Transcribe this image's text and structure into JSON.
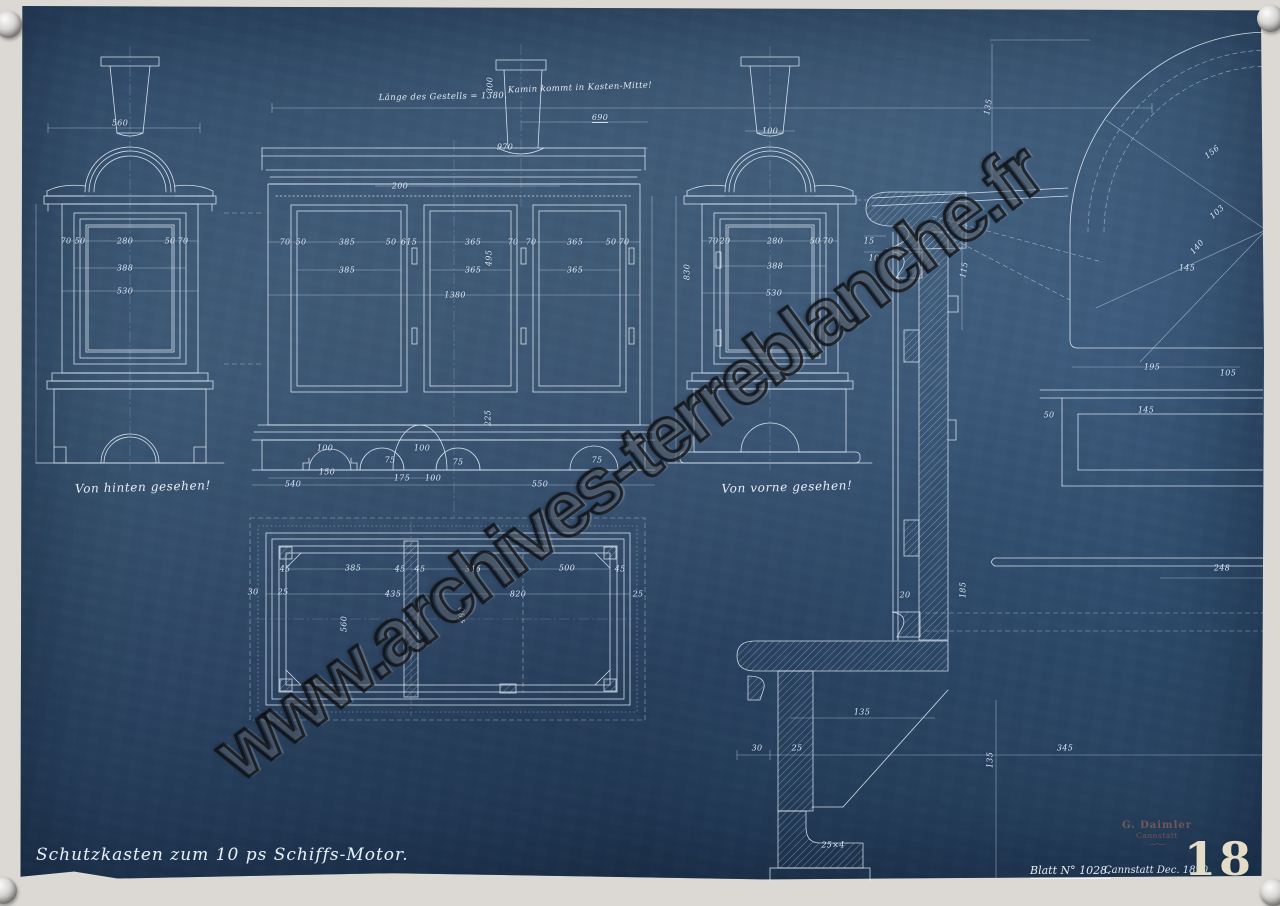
{
  "document": {
    "title": "Schutzkasten zum 10 ps Schiffs-Motor.",
    "sheet_number": "Blatt N° 1028.",
    "place_date": "Cannstatt Dec. 1890.",
    "page_number": "18",
    "stamp": {
      "line1": "G. Daimler",
      "line2": "Cannstatt",
      "rule": "—··—"
    }
  },
  "watermark": {
    "text": "www.archives-terreblanche.fr"
  },
  "annotations": {
    "length_note": "Länge des Gestells = 1380.",
    "chimney_note": "Kamin kommt in Kasten-Mitte!",
    "back_view_caption": "Von hinten gesehen!",
    "front_view_caption": "Von vorne gesehen!"
  },
  "colors": {
    "paper_blue": "#2f4e6f",
    "line_white": "#e9f2fa",
    "margin_paper": "#dcd9d4",
    "stamp_red": "#9a5a4c",
    "stencil_cream": "#e3dcc6"
  },
  "drawing": {
    "dimensions": [
      {
        "t": "560",
        "x": 120,
        "y": 123
      },
      {
        "t": "70",
        "x": 66,
        "y": 241
      },
      {
        "t": "50",
        "x": 80,
        "y": 241
      },
      {
        "t": "280",
        "x": 125,
        "y": 241
      },
      {
        "t": "50",
        "x": 170,
        "y": 241
      },
      {
        "t": "70",
        "x": 183,
        "y": 241
      },
      {
        "t": "388",
        "x": 125,
        "y": 268
      },
      {
        "t": "530",
        "x": 125,
        "y": 291
      },
      {
        "t": "690",
        "x": 600,
        "y": 118,
        "u": true
      },
      {
        "t": "970",
        "x": 505,
        "y": 147
      },
      {
        "t": "300",
        "x": 490,
        "y": 85,
        "r": -90
      },
      {
        "t": "200",
        "x": 400,
        "y": 186
      },
      {
        "t": "70",
        "x": 285,
        "y": 242
      },
      {
        "t": "50",
        "x": 301,
        "y": 242
      },
      {
        "t": "385",
        "x": 347,
        "y": 242
      },
      {
        "t": "50",
        "x": 391,
        "y": 242
      },
      {
        "t": "615",
        "x": 409,
        "y": 242
      },
      {
        "t": "365",
        "x": 473,
        "y": 242
      },
      {
        "t": "70",
        "x": 513,
        "y": 242
      },
      {
        "t": "70",
        "x": 531,
        "y": 242
      },
      {
        "t": "365",
        "x": 575,
        "y": 242
      },
      {
        "t": "50",
        "x": 611,
        "y": 242
      },
      {
        "t": "70",
        "x": 624,
        "y": 242
      },
      {
        "t": "495",
        "x": 489,
        "y": 258,
        "r": -90
      },
      {
        "t": "385",
        "x": 347,
        "y": 270
      },
      {
        "t": "365",
        "x": 473,
        "y": 270
      },
      {
        "t": "365",
        "x": 575,
        "y": 270
      },
      {
        "t": "1380",
        "x": 455,
        "y": 295
      },
      {
        "t": "225",
        "x": 488,
        "y": 418,
        "r": -90
      },
      {
        "t": "100",
        "x": 325,
        "y": 448
      },
      {
        "t": "150",
        "x": 327,
        "y": 472
      },
      {
        "t": "75",
        "x": 390,
        "y": 460
      },
      {
        "t": "100",
        "x": 422,
        "y": 448
      },
      {
        "t": "75",
        "x": 458,
        "y": 462
      },
      {
        "t": "75",
        "x": 597,
        "y": 460
      },
      {
        "t": "540",
        "x": 293,
        "y": 484
      },
      {
        "t": "175",
        "x": 402,
        "y": 478
      },
      {
        "t": "100",
        "x": 433,
        "y": 478
      },
      {
        "t": "550",
        "x": 540,
        "y": 484
      },
      {
        "t": "45",
        "x": 285,
        "y": 569
      },
      {
        "t": "385",
        "x": 353,
        "y": 568
      },
      {
        "t": "45",
        "x": 400,
        "y": 569
      },
      {
        "t": "45",
        "x": 420,
        "y": 569
      },
      {
        "t": "345",
        "x": 473,
        "y": 569
      },
      {
        "t": "500",
        "x": 567,
        "y": 568
      },
      {
        "t": "45",
        "x": 620,
        "y": 569
      },
      {
        "t": "30",
        "x": 253,
        "y": 592
      },
      {
        "t": "25",
        "x": 283,
        "y": 592
      },
      {
        "t": "435",
        "x": 393,
        "y": 594
      },
      {
        "t": "820",
        "x": 518,
        "y": 594
      },
      {
        "t": "25",
        "x": 638,
        "y": 594
      },
      {
        "t": "560",
        "x": 344,
        "y": 624,
        "r": -90
      },
      {
        "t": "480",
        "x": 462,
        "y": 615,
        "r": -90
      },
      {
        "t": "100",
        "x": 770,
        "y": 131
      },
      {
        "t": "70",
        "x": 713,
        "y": 241
      },
      {
        "t": "20",
        "x": 725,
        "y": 241
      },
      {
        "t": "280",
        "x": 775,
        "y": 241
      },
      {
        "t": "50",
        "x": 815,
        "y": 241
      },
      {
        "t": "70",
        "x": 828,
        "y": 241
      },
      {
        "t": "388",
        "x": 775,
        "y": 266
      },
      {
        "t": "530",
        "x": 774,
        "y": 293
      },
      {
        "t": "830",
        "x": 687,
        "y": 272,
        "r": -90
      },
      {
        "t": "135",
        "x": 988,
        "y": 107,
        "r": -80
      },
      {
        "t": "115",
        "x": 964,
        "y": 270,
        "r": -80
      },
      {
        "t": "15",
        "x": 869,
        "y": 241
      },
      {
        "t": "10",
        "x": 874,
        "y": 258
      },
      {
        "t": "156",
        "x": 1212,
        "y": 152,
        "r": -38
      },
      {
        "t": "103",
        "x": 1217,
        "y": 212,
        "r": -42
      },
      {
        "t": "140",
        "x": 1197,
        "y": 247,
        "r": -48
      },
      {
        "t": "145",
        "x": 1187,
        "y": 268
      },
      {
        "t": "195",
        "x": 1152,
        "y": 367
      },
      {
        "t": "105",
        "x": 1228,
        "y": 373
      },
      {
        "t": "50",
        "x": 1049,
        "y": 415
      },
      {
        "t": "145",
        "x": 1146,
        "y": 410
      },
      {
        "t": "248",
        "x": 1222,
        "y": 568
      },
      {
        "t": "185",
        "x": 963,
        "y": 590,
        "r": -90
      },
      {
        "t": "20",
        "x": 905,
        "y": 595
      },
      {
        "t": "135",
        "x": 862,
        "y": 712
      },
      {
        "t": "30",
        "x": 757,
        "y": 748
      },
      {
        "t": "25",
        "x": 797,
        "y": 748
      },
      {
        "t": "345",
        "x": 1065,
        "y": 748
      },
      {
        "t": "135",
        "x": 990,
        "y": 760,
        "r": -90
      },
      {
        "t": "25×4",
        "x": 833,
        "y": 845
      }
    ]
  }
}
